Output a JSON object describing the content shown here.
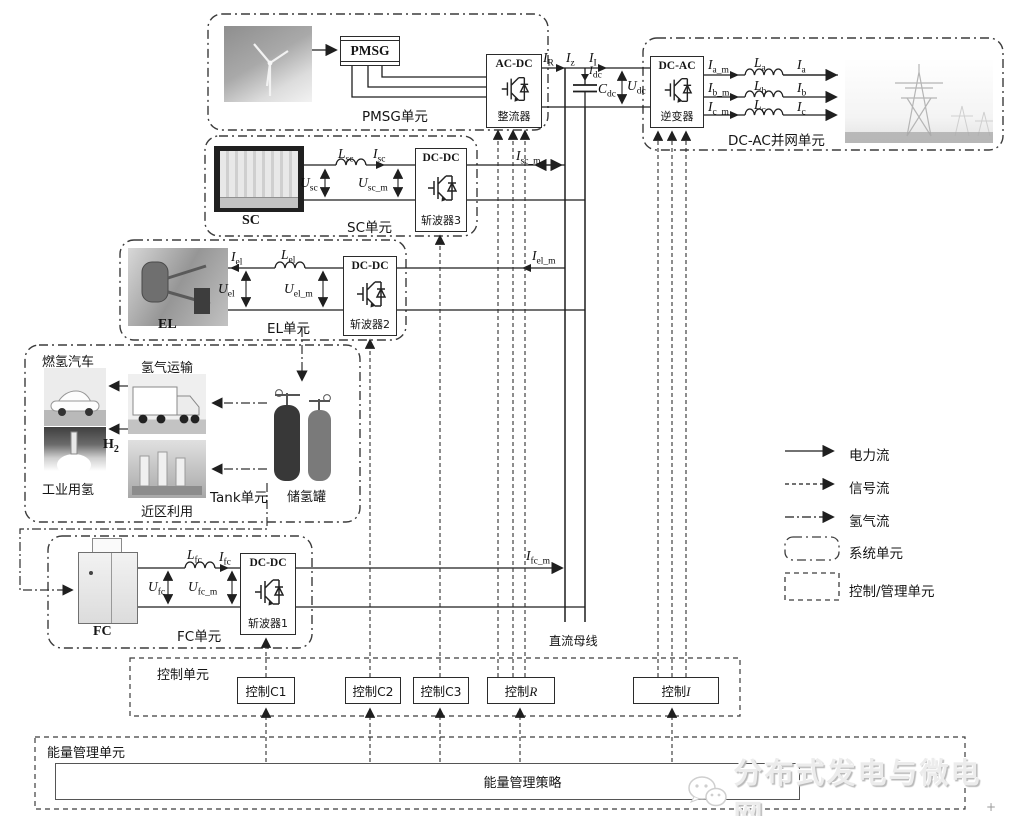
{
  "pmsg": {
    "unit": "PMSG单元",
    "gen": "PMSG",
    "conv_type": "AC-DC",
    "conv_name": "整流器"
  },
  "grid": {
    "unit": "DC-AC并网单元",
    "conv_type": "DC-AC",
    "conv_name": "逆变器",
    "phases": [
      {
        "im": {
          "b": "I",
          "s": "a_m"
        },
        "l": {
          "b": "L",
          "s": "a"
        },
        "i": {
          "b": "I",
          "s": "a"
        }
      },
      {
        "im": {
          "b": "I",
          "s": "b_m"
        },
        "l": {
          "b": "L",
          "s": "b"
        },
        "i": {
          "b": "I",
          "s": "b"
        }
      },
      {
        "im": {
          "b": "I",
          "s": "c_m"
        },
        "l": {
          "b": "L",
          "s": "c"
        },
        "i": {
          "b": "I",
          "s": "c"
        }
      }
    ]
  },
  "dclink": {
    "ir": {
      "b": "I",
      "s": "R"
    },
    "iz": {
      "b": "I",
      "s": "z"
    },
    "ii": {
      "b": "I",
      "s": "I"
    },
    "idc": {
      "b": "I",
      "s": "dc"
    },
    "cdc": {
      "b": "C",
      "s": "dc"
    },
    "udc": {
      "b": "U",
      "s": "dc"
    }
  },
  "sc": {
    "unit": "SC单元",
    "dev": "SC",
    "conv_type": "DC-DC",
    "conv_name": "斩波器3",
    "usc": {
      "b": "U",
      "s": "sc"
    },
    "lsc": {
      "b": "L",
      "s": "sc"
    },
    "isc": {
      "b": "I",
      "s": "sc"
    },
    "uscm": {
      "b": "U",
      "s": "sc_m"
    },
    "iscm": {
      "b": "I",
      "s": "sc_m"
    }
  },
  "el": {
    "unit": "EL单元",
    "dev": "EL",
    "conv_type": "DC-DC",
    "conv_name": "斩波器2",
    "iel": {
      "b": "I",
      "s": "el"
    },
    "lel": {
      "b": "L",
      "s": "el"
    },
    "uel": {
      "b": "U",
      "s": "el"
    },
    "uelm": {
      "b": "U",
      "s": "el_m"
    },
    "ielm": {
      "b": "I",
      "s": "el_m"
    }
  },
  "fc": {
    "unit": "FC单元",
    "dev": "FC",
    "conv_type": "DC-DC",
    "conv_name": "斩波器1",
    "ufc": {
      "b": "U",
      "s": "fc"
    },
    "lfc": {
      "b": "L",
      "s": "fc"
    },
    "ifc": {
      "b": "I",
      "s": "fc"
    },
    "ufcm": {
      "b": "U",
      "s": "fc_m"
    },
    "ifcm": {
      "b": "I",
      "s": "fc_m"
    }
  },
  "tank": {
    "unit": "Tank单元",
    "car": "燃氢汽车",
    "transport": "氢气运输",
    "industry": "工业用氢",
    "local": "近区利用",
    "storage": "储氢罐",
    "h2": {
      "b": "H",
      "s": "2"
    }
  },
  "bus": {
    "label": "直流母线"
  },
  "control": {
    "unit": "控制单元",
    "c1": "控制C1",
    "c2": "控制C2",
    "c3": "控制C3",
    "r": {
      "pre": "控制",
      "it": "R"
    },
    "i": {
      "pre": "控制",
      "it": "I"
    }
  },
  "ems": {
    "unit": "能量管理单元",
    "strategy": "能量管理策略"
  },
  "legend": {
    "power": "电力流",
    "signal": "信号流",
    "hydrogen": "氢气流",
    "system_unit": "系统单元",
    "control_unit": "控制/管理单元"
  },
  "watermark": {
    "text": "分布式发电与微电网"
  },
  "misc": {
    "corner_mark": "+"
  }
}
